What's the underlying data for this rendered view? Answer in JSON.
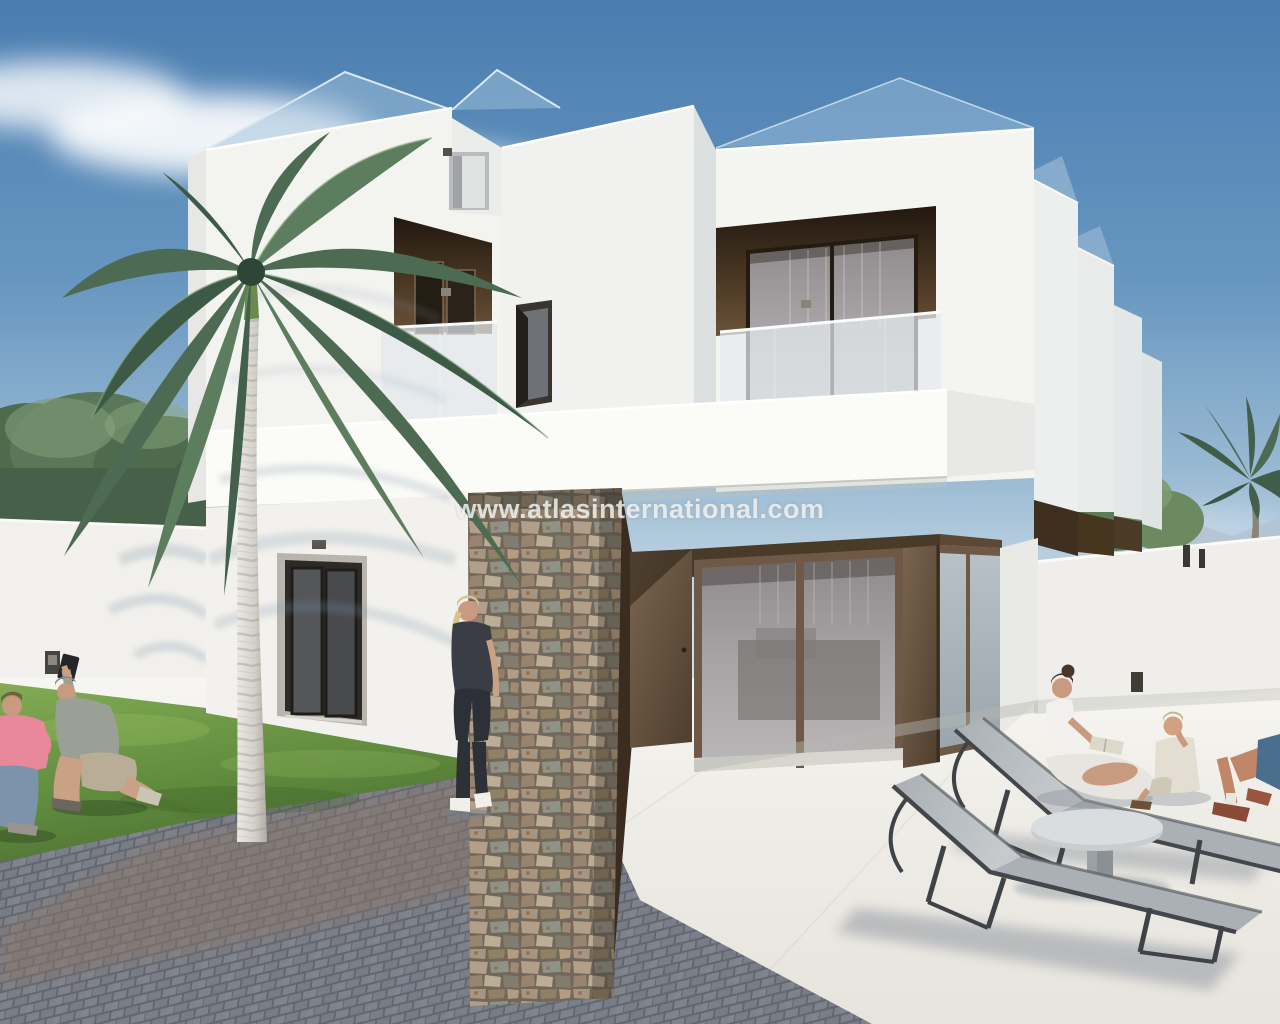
{
  "watermark": {
    "text": "www.atlasinternational.com"
  },
  "palette": {
    "sky_top": "#4a7db0",
    "sky_horizon": "#cfdee9",
    "wall_white": "#f3f3f0",
    "wall_shaded": "#dde0e1",
    "recess_brown_dark": "#241a10",
    "recess_brown_light": "#6a523a",
    "window_frame_brown": "#6d5945",
    "corner_glass": "#a9b3ba",
    "balustrade_glass": "#e2e8ec",
    "stone_tan": "#b3a18c",
    "grass_green": "#6f9a4c",
    "paver_gray": "#787b83",
    "paver_brown": "#8a7668",
    "patio_white": "#f2f0ea",
    "palm_green": "#4c6b52",
    "lounger_mesh": "#9aa1a7",
    "lounger_frame": "#3f4347",
    "watermark_color": "#f0f0ee"
  },
  "scene": {
    "type": "architectural-3d-render",
    "objects": [
      "sky",
      "clouds",
      "distant-mountains",
      "background-trees",
      "main-palm-tree",
      "modern-white-villa",
      "roof-glass-railing",
      "roof-access-door",
      "upper-balcony-left",
      "upper-balcony-right",
      "stone-clad-pillar",
      "entrance-door",
      "sliding-glass-door",
      "corner-window",
      "neighbor-houses",
      "perimeter-walls",
      "grass-lawn",
      "paver-path",
      "patio-floor",
      "kneeling-man-taking-photo",
      "child-in-pink",
      "standing-woman",
      "seated-woman-reading",
      "seated-child",
      "partial-person",
      "sun-loungers",
      "round-side-table",
      "watermark-text"
    ]
  }
}
